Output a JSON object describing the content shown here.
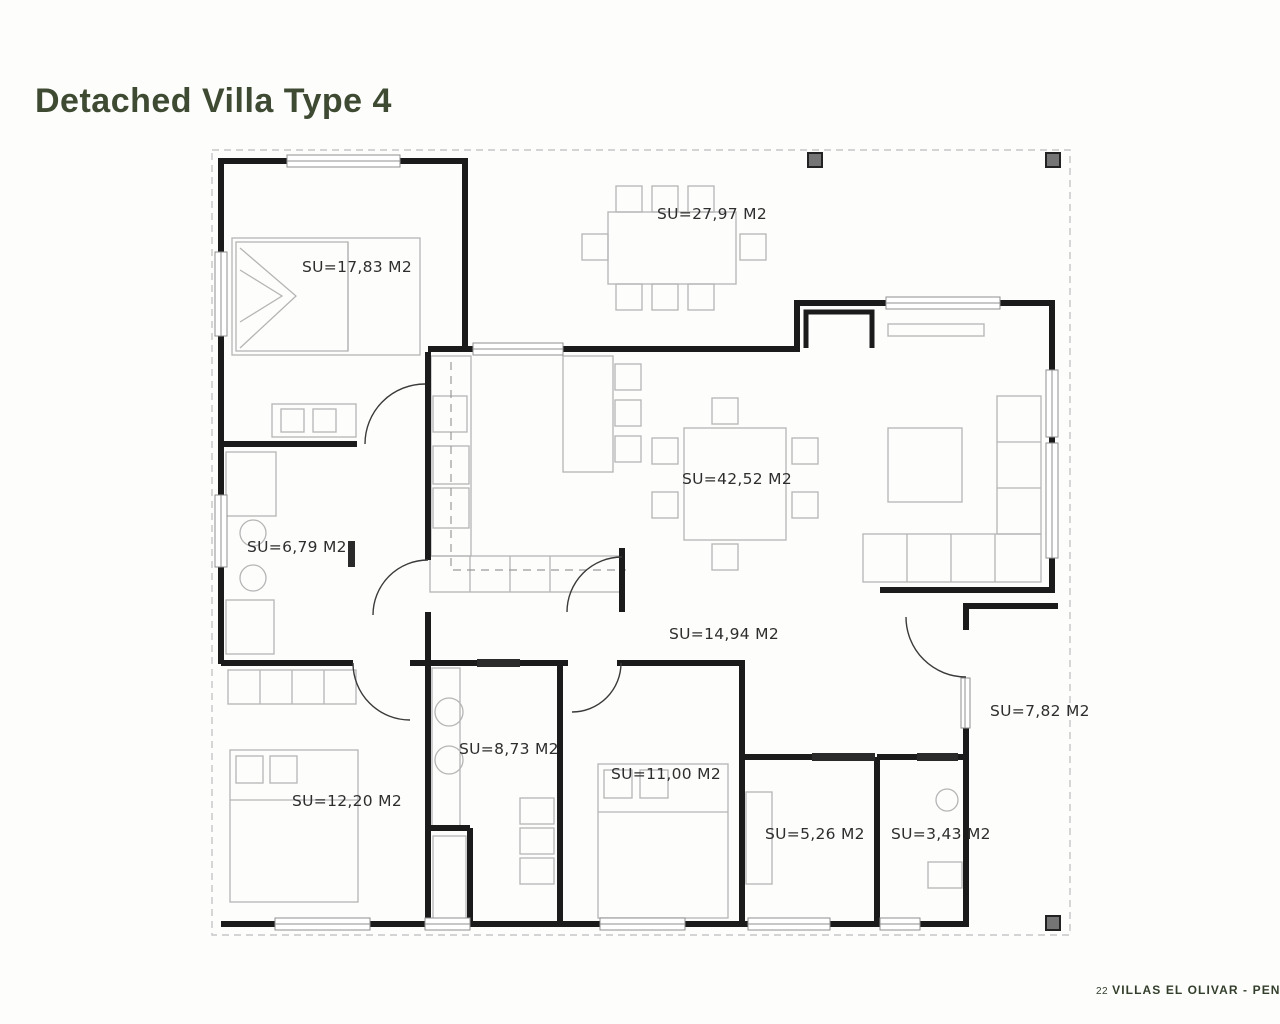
{
  "title": "Detached Villa Type 4",
  "footer": {
    "page_number": "22",
    "project": "VILLAS EL OLIVAR - PENAGUIL"
  },
  "colors": {
    "title_green": "#3e4a31",
    "footer_green": "#333f2b",
    "wall": "#1b1b1b",
    "furniture_gray": "#b5b5b5",
    "boundary_gray": "#c6c6c6",
    "pillar_gray": "#757575",
    "label_text": "#2e2e2e"
  },
  "floorplan": {
    "rooms": [
      {
        "id": "bedroom-main",
        "label": "SU=17,83 M2"
      },
      {
        "id": "terrace-dining",
        "label": "SU=27,97 M2"
      },
      {
        "id": "living-kitchen",
        "label": "SU=42,52 M2"
      },
      {
        "id": "bathroom-ensuite",
        "label": "SU=6,79 M2"
      },
      {
        "id": "hallway",
        "label": "SU=14,94 M2"
      },
      {
        "id": "bathroom-family",
        "label": "SU=8,73 M2"
      },
      {
        "id": "bedroom-2",
        "label": "SU=12,20 M2"
      },
      {
        "id": "bedroom-3",
        "label": "SU=11,00 M2"
      },
      {
        "id": "storage",
        "label": "SU=5,26 M2"
      },
      {
        "id": "wc",
        "label": "SU=3,43 M2"
      },
      {
        "id": "porch",
        "label": "SU=7,82 M2"
      }
    ]
  }
}
